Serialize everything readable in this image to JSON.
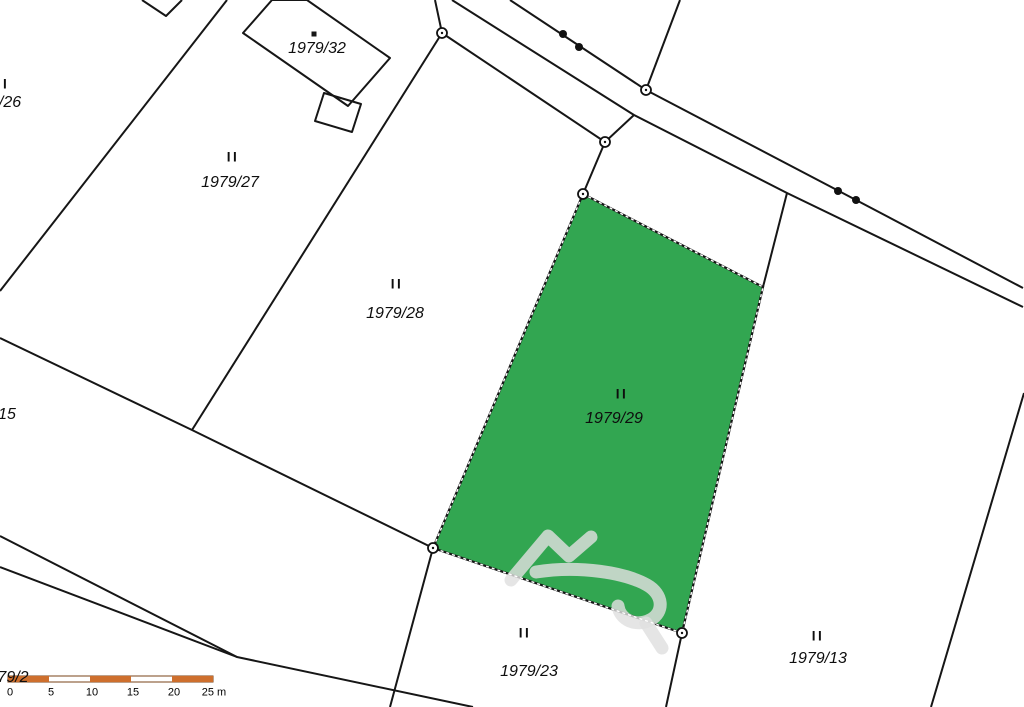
{
  "map": {
    "type": "cadastral-parcel-map",
    "highlighted_parcel": "1979/29",
    "labels": {
      "p26": {
        "marker": "II",
        "number": "/26"
      },
      "p27": {
        "marker": "II",
        "number": "1979/27"
      },
      "p28": {
        "marker": "II",
        "number": "1979/28"
      },
      "p29": {
        "marker": "II",
        "number": "1979/29"
      },
      "p23": {
        "marker": "II",
        "number": "1979/23"
      },
      "p13": {
        "marker": "II",
        "number": "1979/13"
      },
      "p32": {
        "number": "1979/32"
      },
      "p15": {
        "number": "15"
      },
      "p79_2": {
        "number": "79/2"
      }
    },
    "colors": {
      "highlight_green": "#32A651",
      "scale_orange": "#CE6F2D",
      "scale_border": "#7a431a",
      "line_black": "#161616",
      "watermark_gray": "#DFDFDF"
    },
    "scalebar": {
      "ticks": [
        "0",
        "5",
        "10",
        "15",
        "20",
        "25 m"
      ]
    }
  }
}
